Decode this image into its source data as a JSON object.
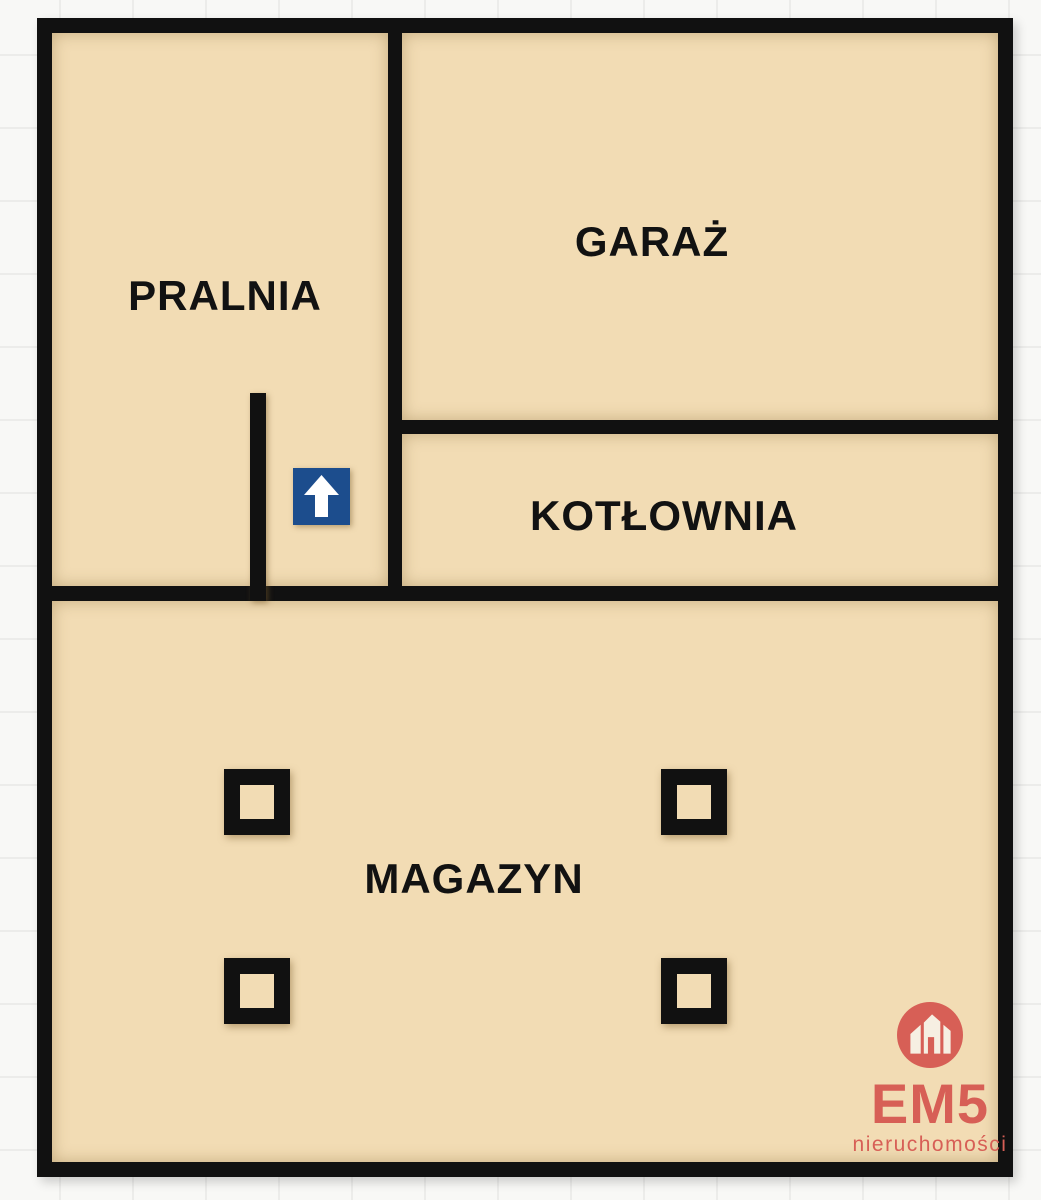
{
  "floorplan": {
    "rooms": [
      {
        "id": "pralnia",
        "label": "PRALNIA"
      },
      {
        "id": "garaz",
        "label": "GARAŻ"
      },
      {
        "id": "kotlownia",
        "label": "KOTŁOWNIA"
      },
      {
        "id": "magazyn",
        "label": "MAGAZYN"
      }
    ],
    "entrance_arrow": {
      "icon": "arrow-up-icon",
      "color": "#1c4d8d"
    },
    "columns_count": 4,
    "colors": {
      "floor": "#f2dcb4",
      "wall": "#111111",
      "background": "#f8f8f6",
      "grid_line": "#ececea"
    }
  },
  "logo": {
    "brand": "EM5",
    "subtitle": "nieruchomości",
    "color": "#d75f56",
    "icon": "house-icon"
  }
}
